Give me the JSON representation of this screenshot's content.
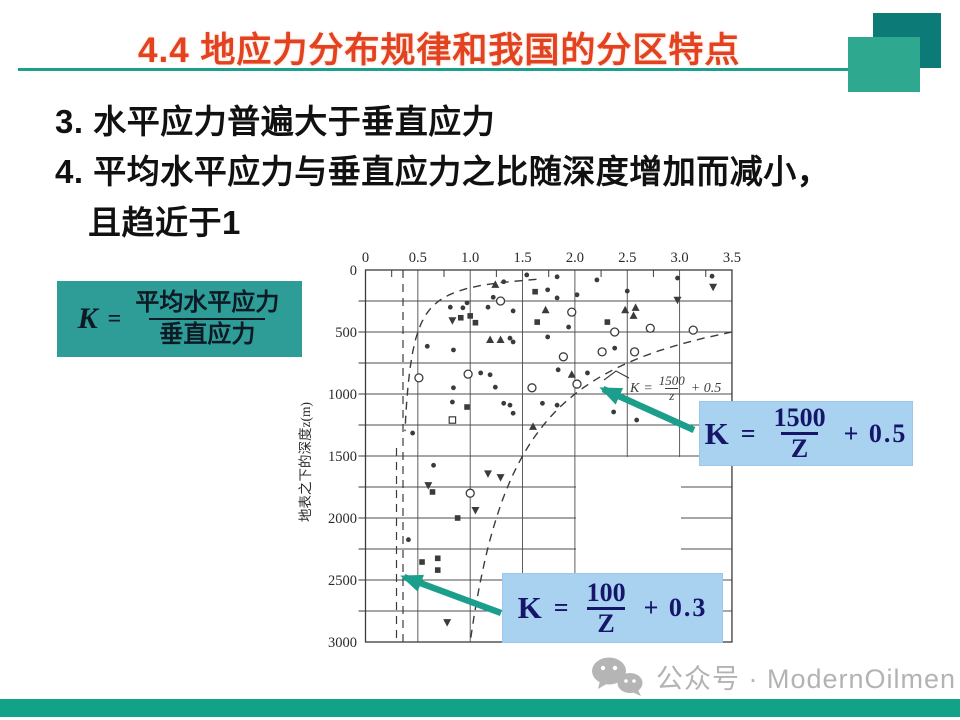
{
  "slide": {
    "title": "4.4 地应力分布规律和我国的分区特点",
    "lines": [
      "3. 水平应力普遍大于垂直应力",
      "4. 平均水平应力与垂直应力之比随深度增加而减小，",
      "且趋近于1"
    ],
    "k_definition": {
      "lhs": "K",
      "eq": "=",
      "numerator": "平均水平应力",
      "denominator": "垂直应力"
    }
  },
  "colors": {
    "title_red": "#e2421f",
    "accent_teal": "#1d9f8e",
    "square_dark": "#0c7a76",
    "square_light": "#2ea88e",
    "kbox_teal": "#2f9d97",
    "formula_box_blue": "#a9d2f1",
    "formula_navy": "#15156a",
    "bottom_bar": "#12a287",
    "watermark_gray": "#b3b3b3",
    "chart_ink": "#3b3b3b"
  },
  "chart_data": {
    "type": "scatter",
    "xlabel": "",
    "ylabel": "地表之下的深度z(m)",
    "x_ticks": [
      "0",
      "0.5",
      "1.0",
      "1.5",
      "2.0",
      "2.5",
      "3.0",
      "3.5"
    ],
    "y_ticks": [
      "0",
      "500",
      "1000",
      "1500",
      "2000",
      "2500",
      "3000"
    ],
    "xlim": [
      0,
      3.5
    ],
    "ylim": [
      0,
      3000
    ],
    "grid": "on, 0.25K verticals at 0.5 / 250 m horizontals",
    "annotation": {
      "lhs": "K",
      "eq": "=",
      "numerator": "1500",
      "denominator": "z",
      "suffix": "+ 0.5"
    },
    "curves": [
      {
        "name": "lower envelope",
        "formula": "K = 100/Z + 0.3",
        "a": 100,
        "b": 0.3
      },
      {
        "name": "upper envelope",
        "formula": "K = 1500/Z + 0.5",
        "a": 1500,
        "b": 0.5
      }
    ],
    "point_types": {
      "d": "filled dot",
      "o": "open circle",
      "t": "filled triangle up",
      "v": "filled triangle down",
      "s": "filled square",
      "q": "open square"
    },
    "points": [
      [
        1.54,
        40,
        "d"
      ],
      [
        1.83,
        55,
        "d"
      ],
      [
        2.21,
        80,
        "d"
      ],
      [
        2.98,
        65,
        "d"
      ],
      [
        3.31,
        50,
        "d"
      ],
      [
        3.32,
        135,
        "v"
      ],
      [
        1.24,
        120,
        "t"
      ],
      [
        1.32,
        95,
        "d"
      ],
      [
        1.62,
        175,
        "s"
      ],
      [
        1.74,
        160,
        "d"
      ],
      [
        1.83,
        225,
        "d"
      ],
      [
        2.02,
        200,
        "d"
      ],
      [
        2.5,
        170,
        "d"
      ],
      [
        2.98,
        240,
        "v"
      ],
      [
        1.22,
        220,
        "d"
      ],
      [
        1.29,
        250,
        "o"
      ],
      [
        0.97,
        265,
        "d"
      ],
      [
        0.81,
        300,
        "d"
      ],
      [
        0.93,
        305,
        "d"
      ],
      [
        1.72,
        325,
        "t"
      ],
      [
        1.97,
        340,
        "o"
      ],
      [
        2.48,
        325,
        "t"
      ],
      [
        2.58,
        305,
        "t"
      ],
      [
        2.56,
        370,
        "t"
      ],
      [
        2.72,
        470,
        "o"
      ],
      [
        2.31,
        420,
        "s"
      ],
      [
        1.64,
        420,
        "s"
      ],
      [
        1.94,
        460,
        "d"
      ],
      [
        0.91,
        385,
        "s"
      ],
      [
        1.0,
        370,
        "s"
      ],
      [
        0.83,
        405,
        "v"
      ],
      [
        1.05,
        425,
        "s"
      ],
      [
        1.17,
        300,
        "d"
      ],
      [
        1.41,
        330,
        "d"
      ],
      [
        3.13,
        485,
        "o"
      ],
      [
        2.38,
        500,
        "o"
      ],
      [
        1.19,
        565,
        "t"
      ],
      [
        1.29,
        565,
        "t"
      ],
      [
        1.38,
        550,
        "d"
      ],
      [
        1.41,
        580,
        "d"
      ],
      [
        0.59,
        615,
        "d"
      ],
      [
        0.84,
        645,
        "d"
      ],
      [
        1.74,
        540,
        "d"
      ],
      [
        1.89,
        700,
        "o"
      ],
      [
        2.26,
        660,
        "o"
      ],
      [
        2.38,
        630,
        "d"
      ],
      [
        2.57,
        660,
        "o"
      ],
      [
        1.84,
        805,
        "d"
      ],
      [
        1.97,
        845,
        "t"
      ],
      [
        2.12,
        830,
        "d"
      ],
      [
        0.51,
        870,
        "o"
      ],
      [
        0.98,
        840,
        "o"
      ],
      [
        1.1,
        830,
        "d"
      ],
      [
        1.19,
        845,
        "d"
      ],
      [
        0.84,
        950,
        "d"
      ],
      [
        1.24,
        945,
        "d"
      ],
      [
        1.59,
        950,
        "o"
      ],
      [
        2.02,
        920,
        "o"
      ],
      [
        0.83,
        1065,
        "d"
      ],
      [
        0.97,
        1105,
        "s"
      ],
      [
        1.32,
        1075,
        "d"
      ],
      [
        1.38,
        1090,
        "d"
      ],
      [
        1.41,
        1155,
        "d"
      ],
      [
        1.69,
        1075,
        "d"
      ],
      [
        1.83,
        1090,
        "d"
      ],
      [
        2.37,
        1145,
        "d"
      ],
      [
        2.59,
        1210,
        "d"
      ],
      [
        1.6,
        1265,
        "t"
      ],
      [
        0.83,
        1210,
        "q"
      ],
      [
        0.45,
        1315,
        "d"
      ],
      [
        0.65,
        1575,
        "d"
      ],
      [
        1.17,
        1640,
        "v"
      ],
      [
        1.29,
        1670,
        "v"
      ],
      [
        0.6,
        1735,
        "v"
      ],
      [
        0.64,
        1790,
        "s"
      ],
      [
        1.0,
        1800,
        "o"
      ],
      [
        1.05,
        1935,
        "v"
      ],
      [
        0.88,
        2000,
        "s"
      ],
      [
        0.54,
        2355,
        "s"
      ],
      [
        0.69,
        2325,
        "s"
      ],
      [
        0.69,
        2420,
        "s"
      ],
      [
        0.78,
        2840,
        "v"
      ],
      [
        0.41,
        2175,
        "d"
      ]
    ]
  },
  "formula_boxes": [
    {
      "lhs": "K",
      "eq": "=",
      "numerator": "1500",
      "denominator": "Z",
      "suffix": "+ 0.5"
    },
    {
      "lhs": "K",
      "eq": "=",
      "numerator": "100",
      "denominator": "Z",
      "suffix": "+ 0.3"
    }
  ],
  "footer": {
    "watermark": "公众号 · ModernOilmen"
  }
}
